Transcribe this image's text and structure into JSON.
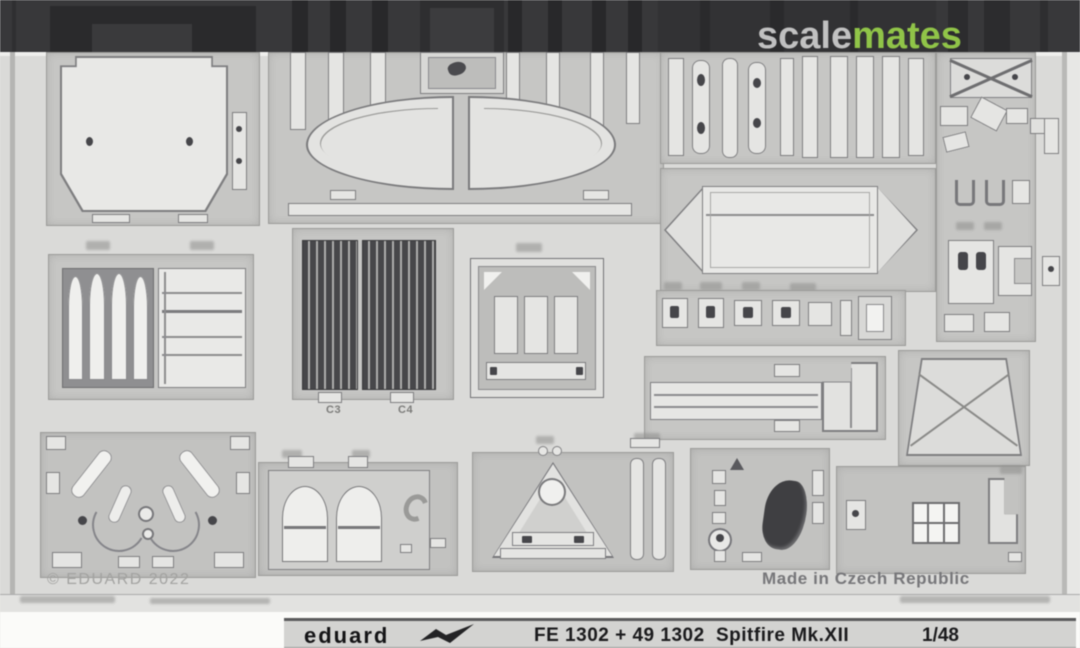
{
  "watermark": {
    "scale": "scale",
    "mates": "mates",
    "scale_color": "#e1e1e1",
    "mates_color": "#8dc63f"
  },
  "fret": {
    "copyright": "© EDUARD 2022",
    "made_in": "Made in Czech Republic",
    "part_labels": {
      "left_grille": "C3",
      "right_grille": "C4"
    }
  },
  "nameplate": {
    "brand": "eduard",
    "code": "FE 1302 + 49 1302",
    "subject": "Spitfire Mk.XII",
    "scale": "1/48"
  },
  "colors": {
    "dark_band": "#38383a",
    "sheet": "#dadad8",
    "etched_field": "#c6c6c4",
    "part": "#e5e5e3",
    "grille_dark": "#47474a",
    "nameplate_text": "#1b1b1d"
  }
}
